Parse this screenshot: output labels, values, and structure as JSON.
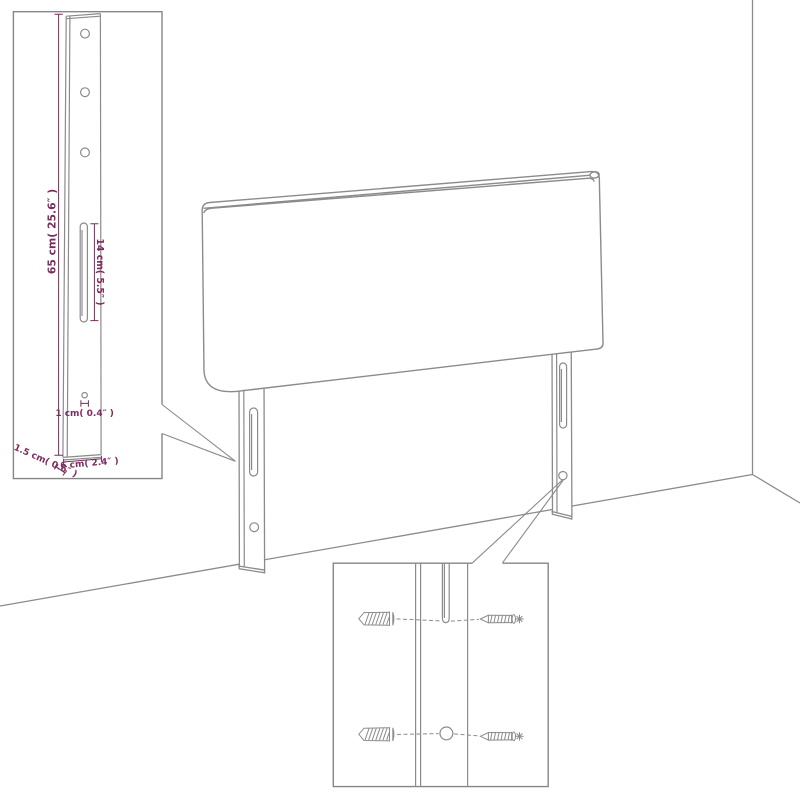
{
  "diagram": {
    "kind": "headboard-assembly-dimension-diagram",
    "colors": {
      "line": "#8b8b8b",
      "dimension": "#7c2b5f",
      "background": "#ffffff"
    },
    "labels": {
      "leg_height": "65 cm( 25.6″ )",
      "slot_length": "14 cm( 5.5″ )",
      "hole_size": "1 cm( 0.4″ )",
      "leg_thickness": "1.5 cm( 0.6″ )",
      "leg_width": "6 cm( 2.4″ )"
    }
  }
}
